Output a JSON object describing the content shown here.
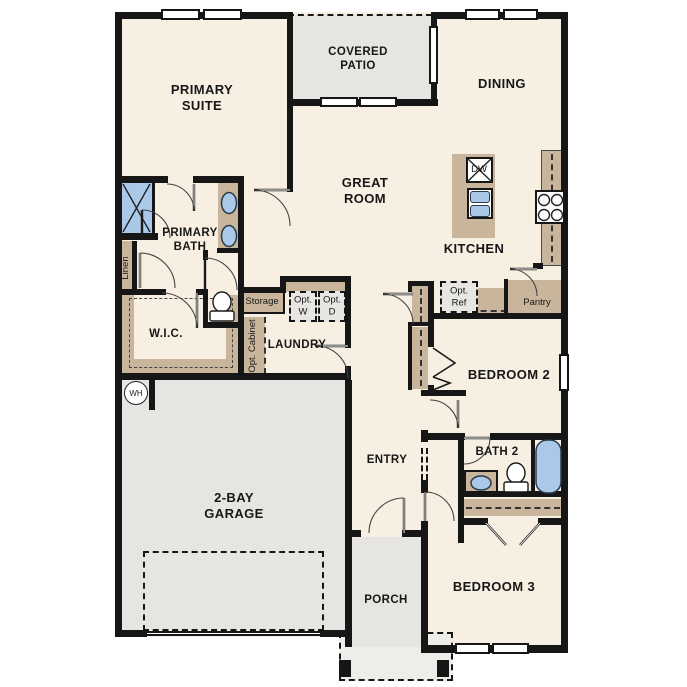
{
  "rooms": [
    {
      "id": "primary-suite",
      "label": "PRIMARY SUITE"
    },
    {
      "id": "covered-patio",
      "label": "COVERED PATIO"
    },
    {
      "id": "dining",
      "label": "DINING"
    },
    {
      "id": "great-room",
      "label": "GREAT ROOM"
    },
    {
      "id": "kitchen",
      "label": "KITCHEN"
    },
    {
      "id": "primary-bath",
      "label": "PRIMARY BATH"
    },
    {
      "id": "wic",
      "label": "W.I.C."
    },
    {
      "id": "laundry",
      "label": "LAUNDRY"
    },
    {
      "id": "entry",
      "label": "ENTRY"
    },
    {
      "id": "garage",
      "label": "2-BAY GARAGE"
    },
    {
      "id": "porch",
      "label": "PORCH"
    },
    {
      "id": "bedroom-2",
      "label": "BEDROOM 2"
    },
    {
      "id": "bath-2",
      "label": "BATH 2"
    },
    {
      "id": "bedroom-3",
      "label": "BEDROOM 3"
    }
  ],
  "fixtures": [
    {
      "id": "linen",
      "label": "Linen"
    },
    {
      "id": "storage",
      "label": "Storage"
    },
    {
      "id": "opt-cabinet",
      "label": "Opt. Cabinet"
    },
    {
      "id": "opt-washer",
      "label": "Opt. W"
    },
    {
      "id": "opt-dryer",
      "label": "Opt. D"
    },
    {
      "id": "opt-refrigerator",
      "label": "Opt. Ref"
    },
    {
      "id": "pantry",
      "label": "Pantry"
    },
    {
      "id": "dishwasher",
      "label": "DW"
    },
    {
      "id": "water-heater",
      "label": "WH"
    }
  ],
  "colors": {
    "floor": "#f7efe1",
    "outdoor": "#e6e5e2",
    "stoop": "#eeede9",
    "cabinet": "#c8b59b",
    "water": "#aac8e8",
    "wall": "#161616",
    "optional": "#e7e6e2"
  }
}
